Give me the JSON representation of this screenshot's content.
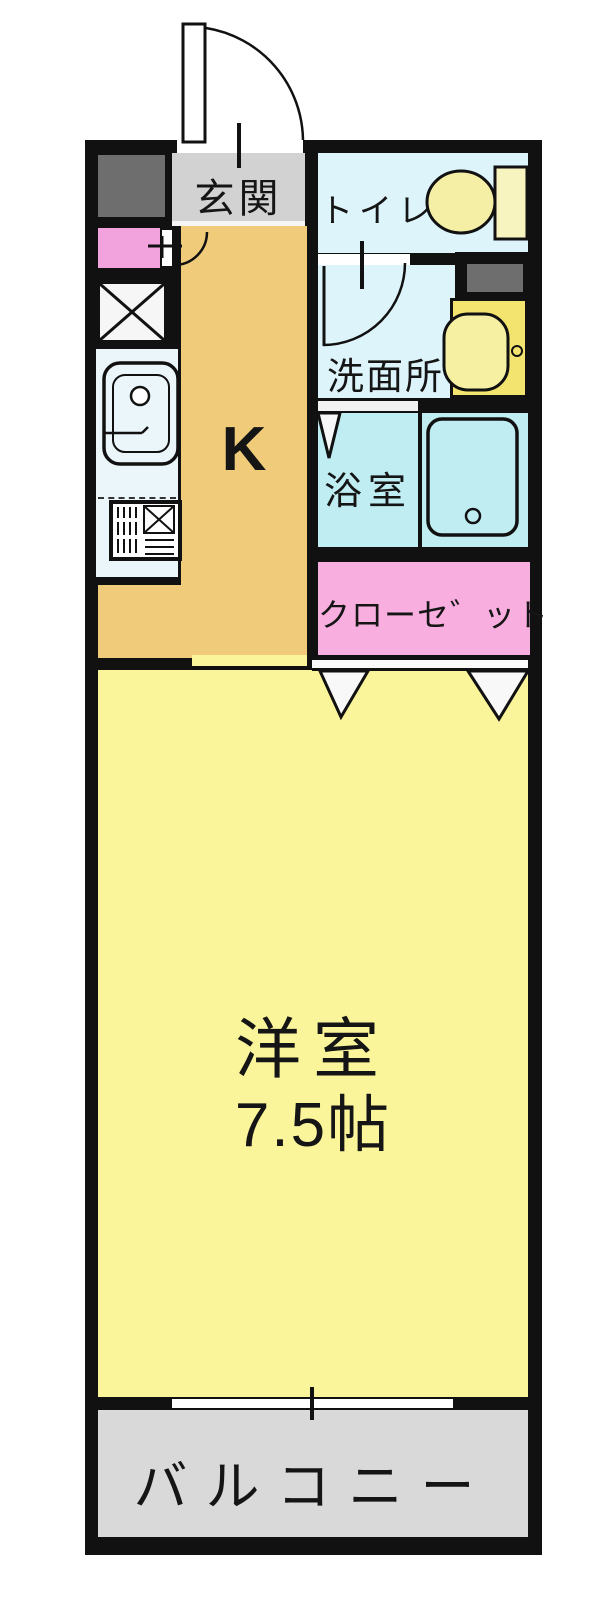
{
  "document": {
    "type": "floor-plan",
    "description": "Japanese apartment 1K floor plan"
  },
  "rooms": {
    "entrance": {
      "label": "玄関"
    },
    "toilet": {
      "label": "トイレ"
    },
    "washroom": {
      "label": "洗面所"
    },
    "bathroom": {
      "label": "浴室"
    },
    "kitchen": {
      "label": "K"
    },
    "closet": {
      "label": "クローセ゛ット"
    },
    "western_room": {
      "label": "洋室",
      "size": "7.5帖"
    },
    "balcony": {
      "label": "バルコニー"
    }
  },
  "colors": {
    "wall": "#111111",
    "kitchen_floor": "#F0CB7A",
    "western_room_floor": "#FAF49B",
    "entrance_floor": "#D2D2D2",
    "wet_area_floor": "#DCF4FA",
    "bathroom_floor": "#BFEDF2",
    "closet_fill": "#F8AEDE",
    "storage_pink": "#F2A3DE",
    "balcony_floor": "#D9D9D9",
    "fixture_yellow": "#F5EFA5",
    "vanity_yellow": "#F2E46E",
    "cabinet_gray": "#6E6E6E"
  },
  "icons": {
    "entrance_door": "quarter-arc swing door",
    "interior_doors": "quarter-arc swing doors",
    "closet_doors": "triangle folding-door marks",
    "bath_door": "triangle folding-door mark",
    "window": "sliding window with center tick",
    "fixtures": "toilet, vanity basin, bathtub, kitchen sink, stove, refrigerator cross box"
  }
}
